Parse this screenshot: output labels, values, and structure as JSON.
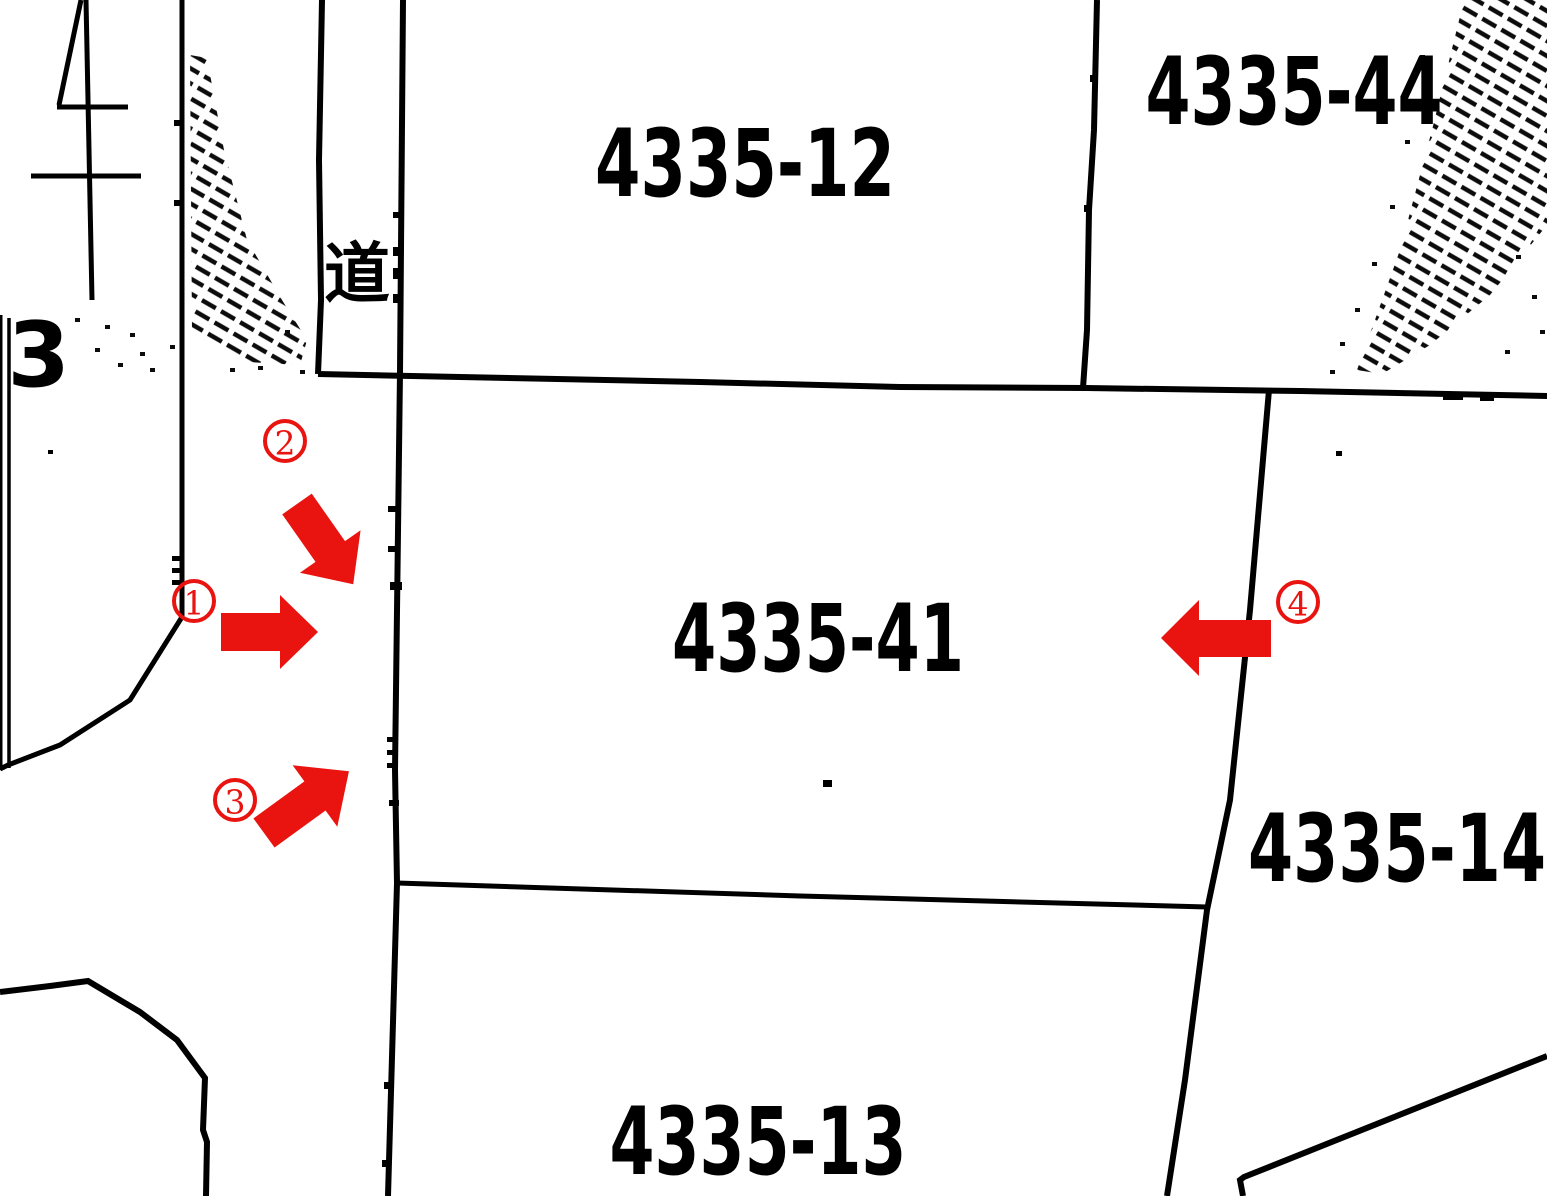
{
  "map": {
    "background_color": "#ffffff",
    "line_color": "#000000",
    "annotation_color": "#e9130f",
    "parcels": [
      {
        "label": "4335-12"
      },
      {
        "label": "4335-44"
      },
      {
        "label": "4335-41"
      },
      {
        "label": "4335-14"
      },
      {
        "label": "4335-13"
      }
    ],
    "road_label": "道",
    "left_edge_label": "-3",
    "markers": [
      {
        "number": "1",
        "arrow_direction": "right"
      },
      {
        "number": "2",
        "arrow_direction": "down-right"
      },
      {
        "number": "3",
        "arrow_direction": "up-right"
      },
      {
        "number": "4",
        "arrow_direction": "left"
      }
    ]
  }
}
